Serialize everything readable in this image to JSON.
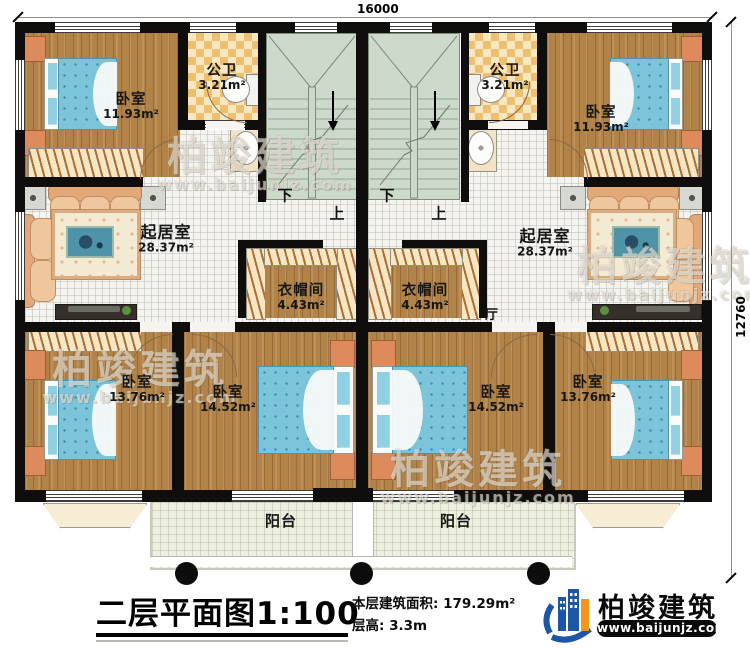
{
  "dimensions": {
    "width": "16000",
    "height": "12760"
  },
  "stairs": {
    "down": "下",
    "up": "上"
  },
  "rooms": {
    "bedroom_tl": {
      "name": "卧室",
      "area": "11.93m²"
    },
    "bedroom_tr": {
      "name": "卧室",
      "area": "11.93m²"
    },
    "bath_l": {
      "name": "公卫",
      "area": "3.21m²"
    },
    "bath_r": {
      "name": "公卫",
      "area": "3.21m²"
    },
    "living_l": {
      "name": "起居室",
      "area": "28.37m²"
    },
    "living_r": {
      "name": "起居室",
      "area": "28.37m²"
    },
    "closet_l": {
      "name": "衣帽间",
      "area": "4.43m²"
    },
    "closet_r": {
      "name": "衣帽间",
      "area": "4.43m²"
    },
    "hall": {
      "name": "厅"
    },
    "bedroom_bl": {
      "name": "卧室",
      "area": "13.76m²"
    },
    "bedroom_bml": {
      "name": "卧室",
      "area": "14.52m²"
    },
    "bedroom_bmr": {
      "name": "卧室",
      "area": "14.52m²"
    },
    "bedroom_br": {
      "name": "卧室",
      "area": "13.76m²"
    },
    "balcony_l": {
      "name": "阳台"
    },
    "balcony_r": {
      "name": "阳台"
    }
  },
  "title_block": {
    "title": "二层平面图",
    "scale": "1:100",
    "area_label": "本层建筑面积:",
    "area_value": "179.29m²",
    "floor_height_label": "层高:",
    "floor_height_value": "3.3m"
  },
  "brand": {
    "name": "柏竣建筑",
    "website": "www.baijunjz.com"
  },
  "watermark": {
    "text": "柏竣建筑",
    "url": "www.baijunjz.com"
  },
  "colors": {
    "wall": "#0f0e0c",
    "wood": "#b28349",
    "tile": "#f5f4f0",
    "stair": "#cdd9cb",
    "checker": "#ecbf71",
    "bed": "#7cc4da",
    "brand_blue": "#1b57a6",
    "brand_orange": "#f7941d"
  }
}
